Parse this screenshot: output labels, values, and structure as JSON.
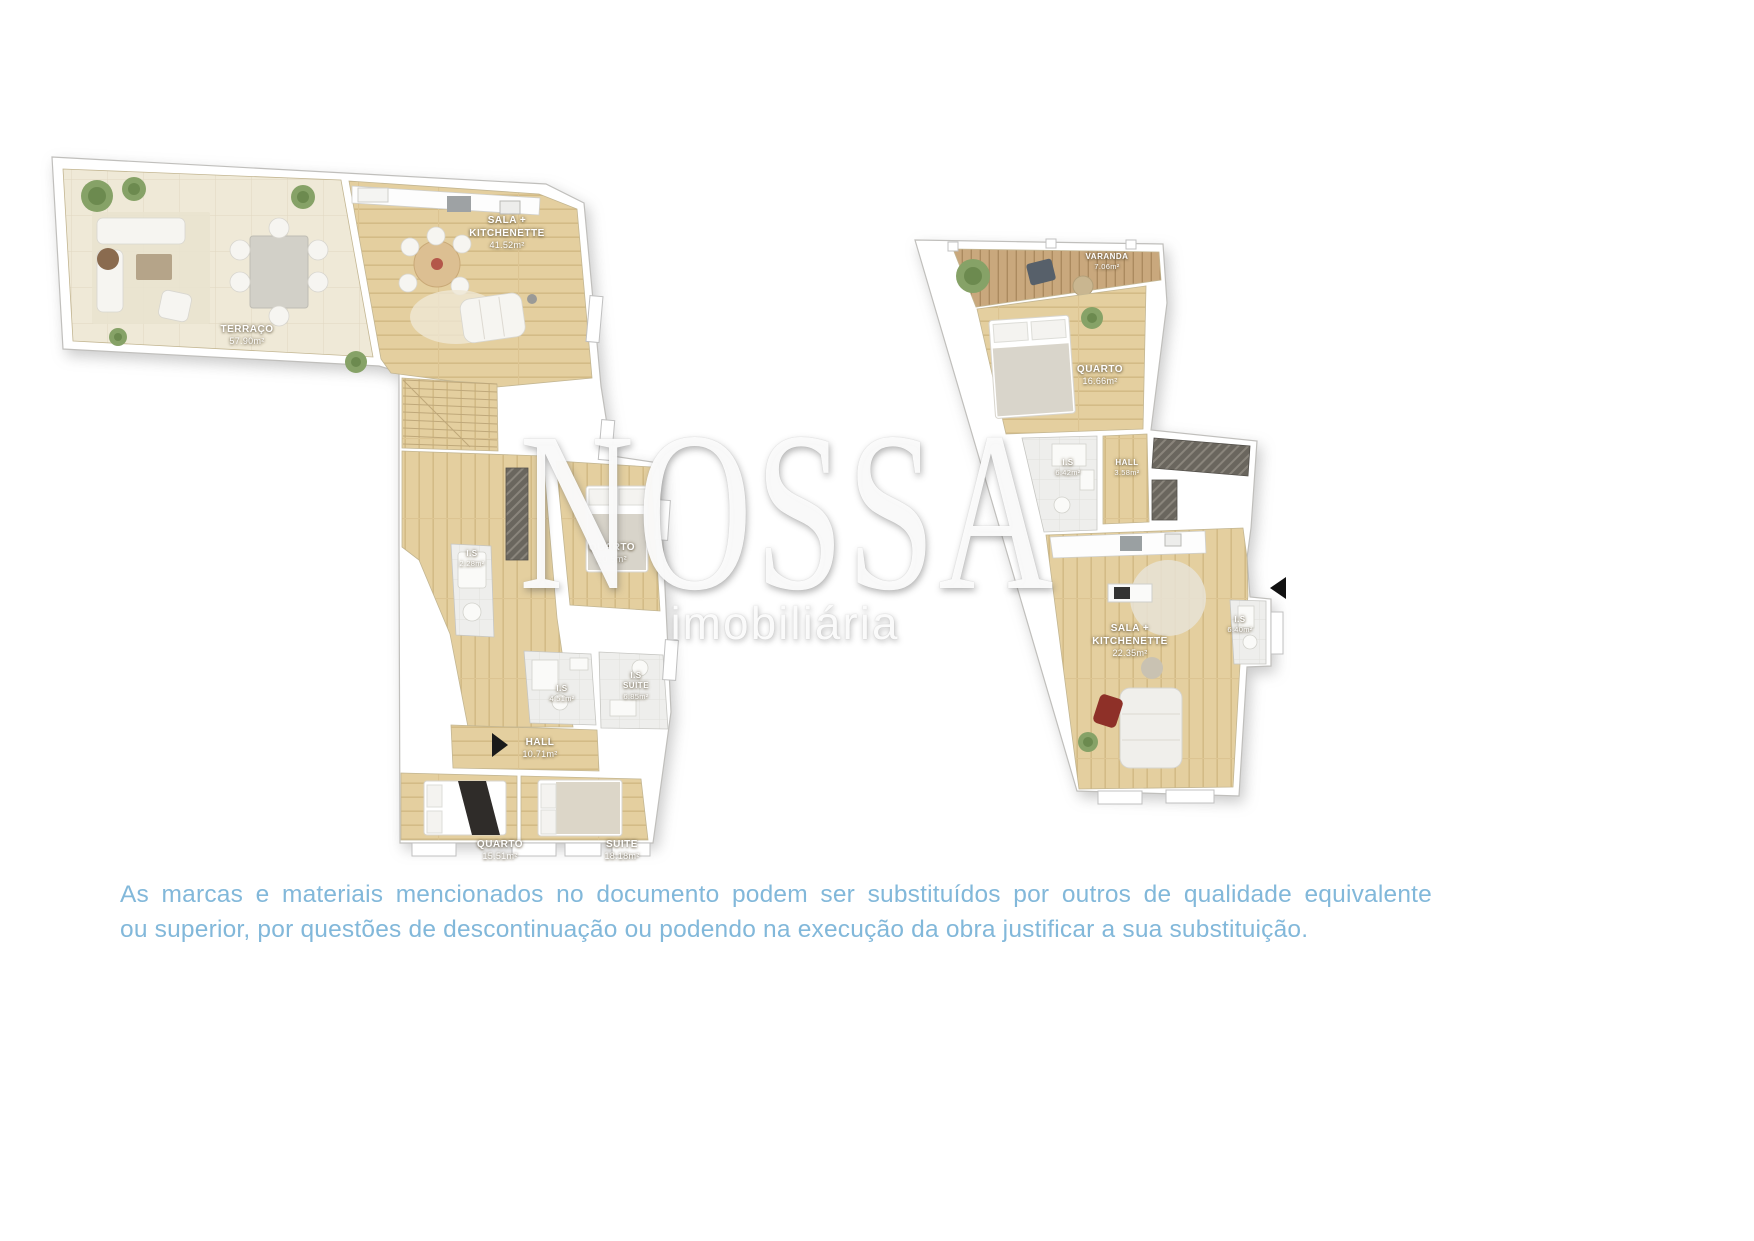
{
  "background_color": "#ffffff",
  "watermark": {
    "title": "NOSSA",
    "subtitle": "imobiliária"
  },
  "disclaimer": {
    "line1": "As marcas e materiais mencionados no documento podem ser substituídos por outros de qualidade equivalente",
    "line2": "ou superior, por questões de descontinuação ou podendo na execução da obra justificar a sua substituição.",
    "color": "#82b8da"
  },
  "plans": [
    {
      "id": "upper-floor-plan",
      "rooms": [
        {
          "name": "SALA +",
          "name2": "KITCHENETTE",
          "area": "41.52m²"
        },
        {
          "name": "TERRAÇO",
          "area": "57.90m²"
        },
        {
          "name": "I.S",
          "area": "2.28m²"
        },
        {
          "name": "QUARTO",
          "area": "10.5m²"
        },
        {
          "name": "I.S",
          "area": "4.51m²"
        },
        {
          "name": "I.S",
          "name2": "SUITE",
          "area": "6.85m²"
        },
        {
          "name": "HALL",
          "area": "10.71m²"
        },
        {
          "name": "QUARTO",
          "area": "15.51m²"
        },
        {
          "name": "SUITE",
          "area": "18.18m²"
        }
      ]
    },
    {
      "id": "lower-floor-plan",
      "rooms": [
        {
          "name": "VARANDA",
          "area": "7.06m²"
        },
        {
          "name": "QUARTO",
          "area": "16.66m²"
        },
        {
          "name": "I.S",
          "area": "6.42m²"
        },
        {
          "name": "HALL",
          "area": "3.58m²"
        },
        {
          "name": "SALA +",
          "name2": "KITCHENETTE",
          "area": "22.35m²"
        },
        {
          "name": "I.S",
          "area": "6.40m²"
        }
      ]
    }
  ]
}
